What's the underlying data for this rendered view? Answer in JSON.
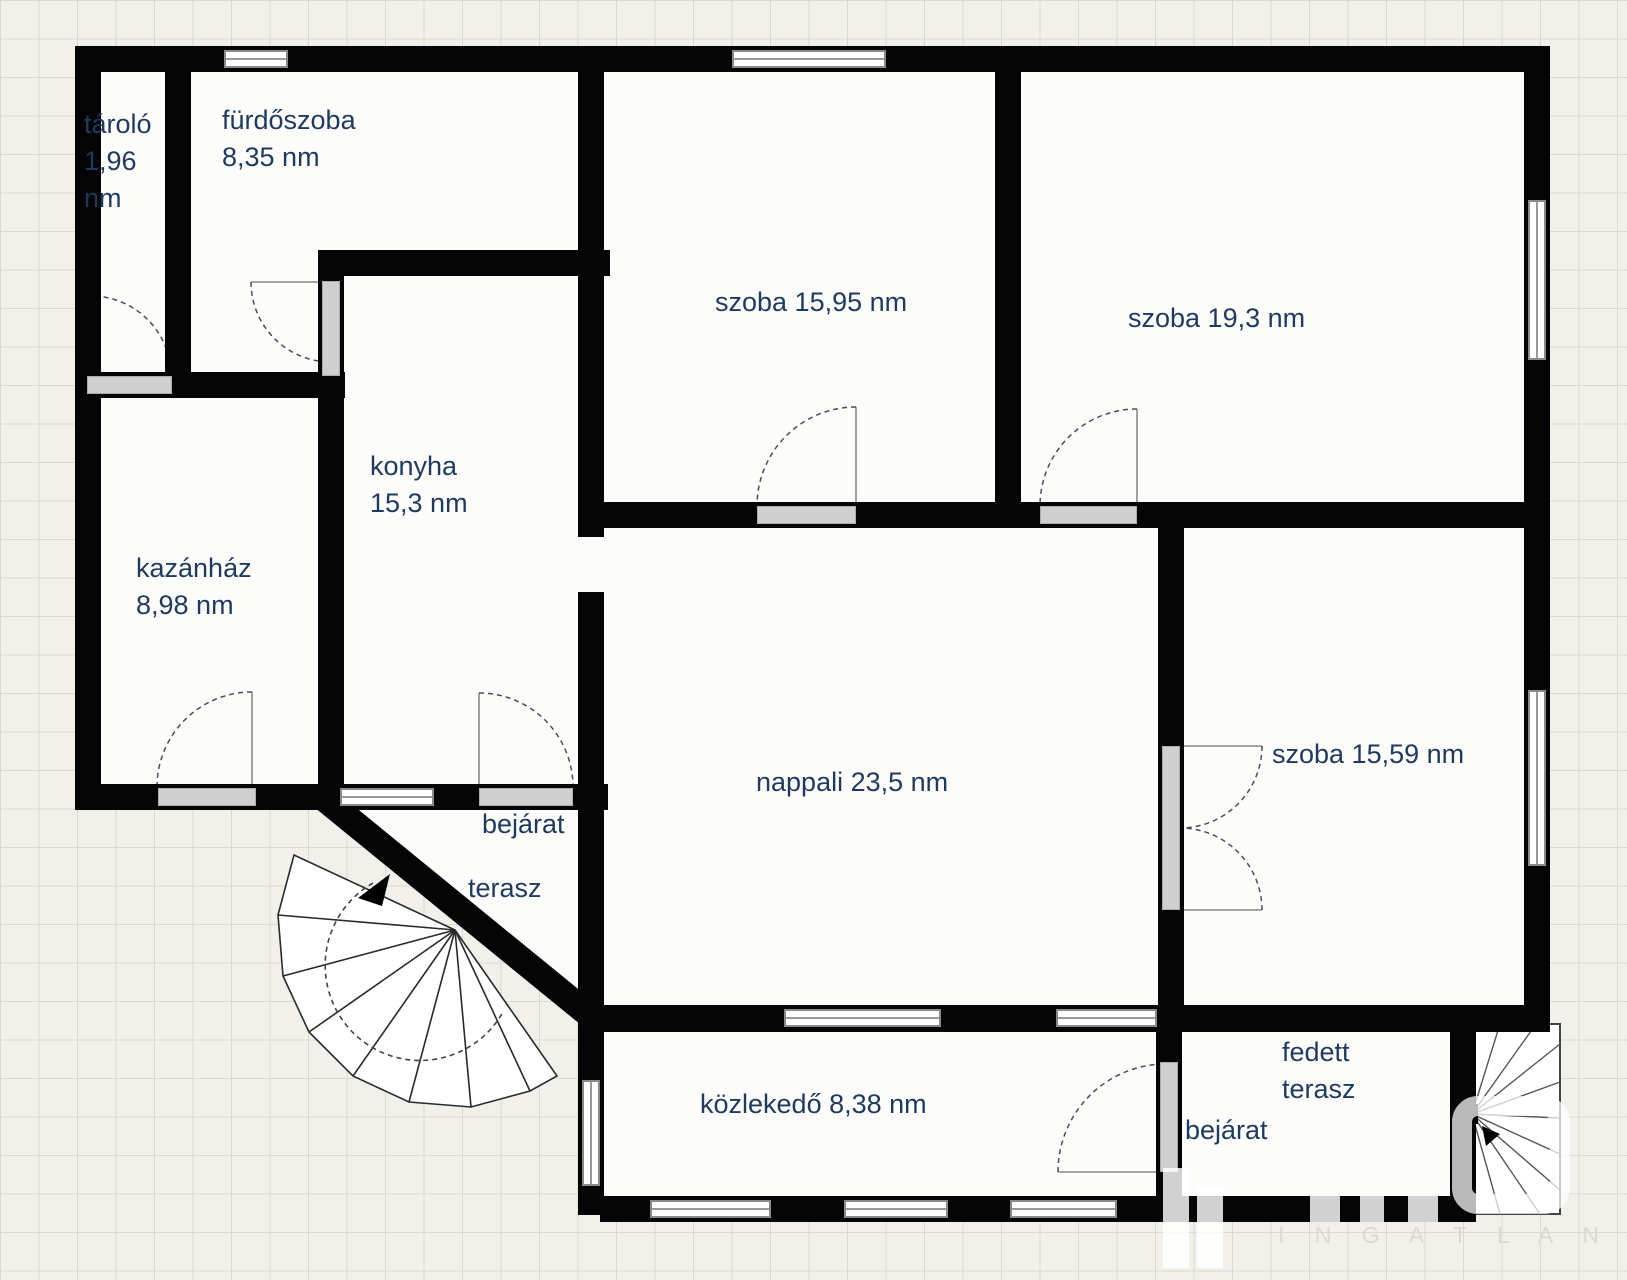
{
  "colors": {
    "label": "#1e3a5f",
    "wall": "#050505",
    "background": "#f2f0ea",
    "threshold": "#cfcfcf"
  },
  "rooms": {
    "tarolo": {
      "lines": [
        "tároló",
        "1,96",
        "nm"
      ]
    },
    "furdoszoba": {
      "lines": [
        "fürdőszoba",
        "8,35 nm"
      ]
    },
    "szoba_top_mid": {
      "label": "szoba 15,95 nm"
    },
    "szoba_top_right": {
      "label": "szoba 19,3 nm"
    },
    "konyha": {
      "lines": [
        "konyha",
        "15,3 nm"
      ]
    },
    "kazanhaz": {
      "lines": [
        "kazánház",
        "8,98 nm"
      ]
    },
    "nappali": {
      "label": "nappali 23,5 nm"
    },
    "szoba_right": {
      "label": "szoba 15,59 nm"
    },
    "kozlekedo": {
      "label": "közlekedő 8,38 nm"
    },
    "fedett_terasz": {
      "lines": [
        "fedett",
        "terasz"
      ]
    },
    "bejarat_terasz": {
      "lines": [
        "bejárat",
        "terasz"
      ]
    },
    "bejarat_back": {
      "label": "bejárat"
    }
  },
  "watermark": {
    "text": "I N G A T L A N Í R O D A"
  }
}
